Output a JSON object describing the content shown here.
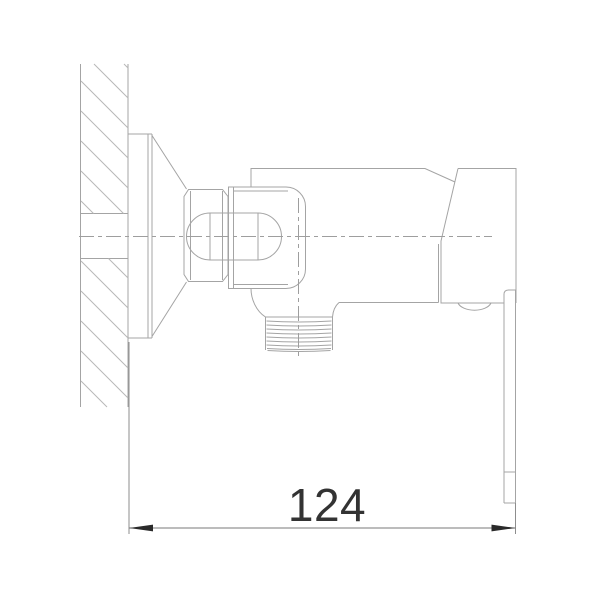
{
  "drawing": {
    "dimension_label": "124",
    "colors": {
      "background": "#ffffff",
      "outline": "#a4a4a4",
      "outline_light": "#b2b2b2",
      "hatch": "#b8b8b8",
      "centerline": "#9e9e9e",
      "extension": "#8d8d8d",
      "dimension_line": "#7a7a7a",
      "arrow": "#2a2a2a",
      "text": "#333333"
    }
  }
}
